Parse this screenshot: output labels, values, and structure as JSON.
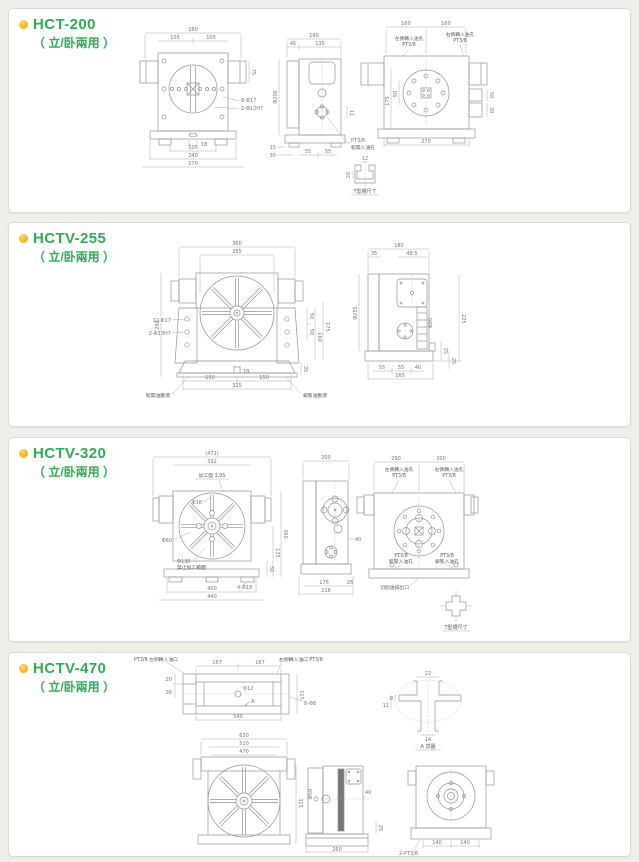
{
  "theme": {
    "accent_green": "#2fae54",
    "bullet_yellow": "#efa000",
    "page_bg": "#edf0e9",
    "panel_bg": "#ffffff",
    "line_gray": "#8f9396"
  },
  "panels": [
    {
      "model": "HCT-200",
      "subtitle": "（ 立/卧兩用 ）",
      "front": {
        "w280": "280",
        "w105a": "105",
        "w105b": "105",
        "b18": "18",
        "b105": "105",
        "b240": "240",
        "b270": "270",
        "r75": "75",
        "note_holes": "8-Φ17",
        "note_pins": "2-Φ12H7"
      },
      "side": {
        "w180": "180",
        "w45": "45",
        "w135": "135",
        "dia200": "Φ200",
        "r11": "11",
        "b15": "15",
        "b30": "30",
        "b55a": "55",
        "b55b": "55",
        "port1": "PT3/8",
        "port2": "鬆開入油孔"
      },
      "slot": {
        "d12": "12",
        "d20": "20",
        "caption": "T型槽尺寸"
      },
      "rear": {
        "t160a": "160",
        "t160b": "160",
        "oilL1": "左側轉入油孔",
        "oilL2": "PT3/8",
        "oilR1": "右側轉入油孔",
        "oilR2": "PT3/8",
        "v175": "175",
        "v50": "50",
        "b270": "270",
        "k50": "50",
        "k30": "30"
      }
    },
    {
      "model": "HCTV-255",
      "subtitle": "（ 立/卧兩用 ）",
      "front": {
        "w360": "360",
        "w255": "255",
        "v292": "292",
        "note_holes": "12-Φ17",
        "note_pins": "2-Φ13H7",
        "b18": "18",
        "b150a": "150",
        "b150b": "150",
        "b325": "325",
        "r50a": "50",
        "r50b": "50",
        "r160": "160",
        "r175": "175",
        "r35": "35",
        "rel": "鬆開油壓源",
        "clp": "鎖緊油壓源"
      },
      "side": {
        "w180": "180",
        "w35": "35",
        "w485": "48.5",
        "dia255": "Φ255",
        "dia20": "Φ20",
        "v225": "225",
        "r25a": "25",
        "r25b": "25",
        "b55a": "55",
        "b55b": "55",
        "b40": "40",
        "b165": "165"
      }
    },
    {
      "model": "HCTV-320",
      "subtitle": "（ 立/卧兩用 ）",
      "front": {
        "w471": "(471)",
        "w392": "392",
        "face": "加工面 3.0S",
        "dia18": "Φ18",
        "dia60": "Φ60",
        "dia130": "Φ130",
        "range": "禁止加工範圍",
        "b400": "400",
        "b440": "440",
        "feet": "4-Φ18",
        "r360": "360",
        "r135": "135",
        "r32": "32"
      },
      "middle": {
        "w200": "200",
        "r40": "40",
        "b176": "176",
        "b26": "26",
        "b218": "218"
      },
      "rear": {
        "t290": "290",
        "t200": "200",
        "oilL1": "左側轉入油孔",
        "oilL2": "PT3/8",
        "oilR1": "右側轉入油孔",
        "oilR2": "PT3/8",
        "rel1": "PT3/8",
        "rel2": "鬆開入油孔",
        "clp1": "PT3/8",
        "clp2": "鎖緊入油孔",
        "drain": "切削油排出口"
      },
      "slot": {
        "caption": "T型槽尺寸"
      }
    },
    {
      "model": "HCTV-470",
      "subtitle": "（ 立/卧兩用 ）",
      "top": {
        "t167a": "167",
        "t167b": "167",
        "b540": "540",
        "l20": "20",
        "l36": "36",
        "r115": "115",
        "holes": "8-Φ8",
        "dia12": "Φ12",
        "mark": "A",
        "oilL": "PT3/8 左側轉入油口",
        "oilR": "右側轉入油口 PT3/8"
      },
      "detail": {
        "d22": "22",
        "d8": "8",
        "d11": "11",
        "d14": "14",
        "caption": "A 詳圖"
      },
      "front": {
        "w630": "630",
        "w510": "510",
        "w470": "470",
        "r315": "315"
      },
      "side": {
        "dia50": "Φ50",
        "r40": "40",
        "r25": "25",
        "b260": "260"
      },
      "rear": {
        "b140a": "140",
        "b140b": "140",
        "ports": "2-PT3/8"
      }
    }
  ]
}
